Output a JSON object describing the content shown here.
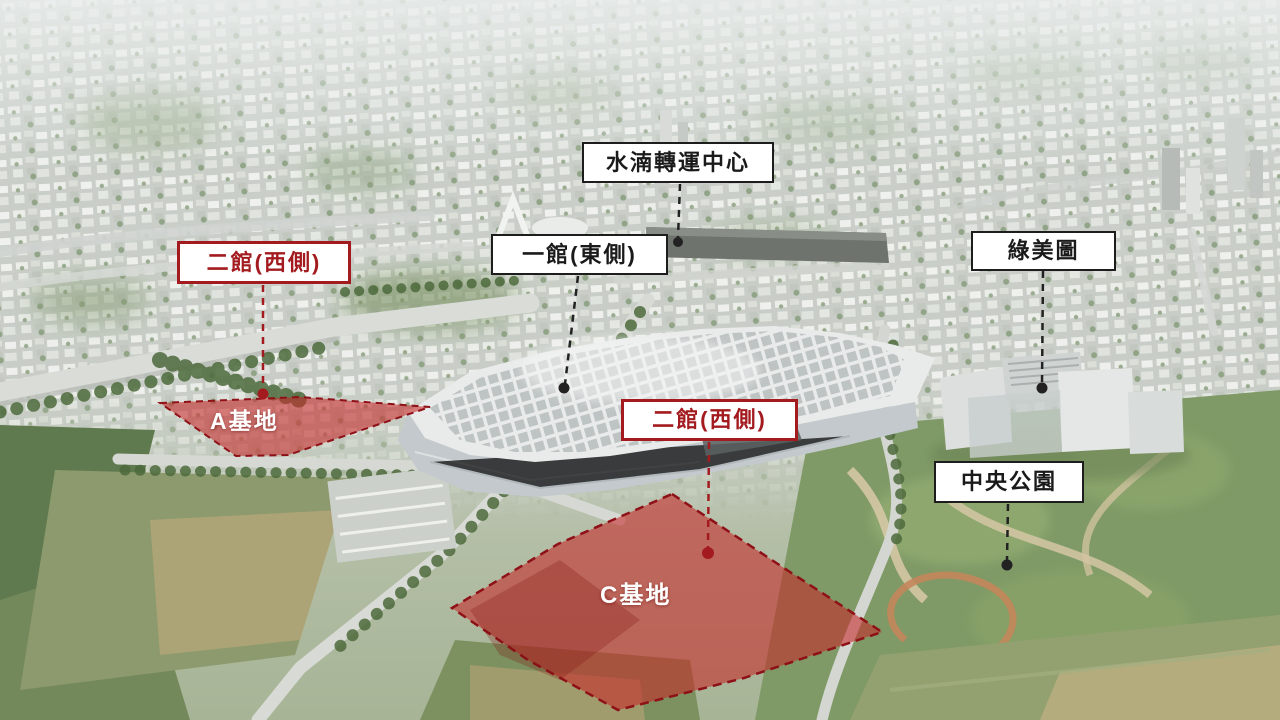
{
  "annotations": {
    "transfer_center": {
      "label": "水湳轉運中心"
    },
    "hall_one_east": {
      "label": "一館(東側)"
    },
    "hall_two_west_left": {
      "label": "二館(西側)"
    },
    "hall_two_west_center": {
      "label": "二館(西側)"
    },
    "green_museumbrary": {
      "label": "綠美圖"
    },
    "central_park": {
      "label": "中央公園"
    },
    "site_a": {
      "label": "A基地"
    },
    "site_c": {
      "label": "C基地"
    }
  },
  "colors": {
    "annotation_red": "#a31b1f",
    "annotation_black": "#1a1a1a",
    "label_background": "#ffffff",
    "site_highlight_fill": "#c62828",
    "site_border_red": "#8e1118",
    "site_label_text": "#ffffff"
  }
}
